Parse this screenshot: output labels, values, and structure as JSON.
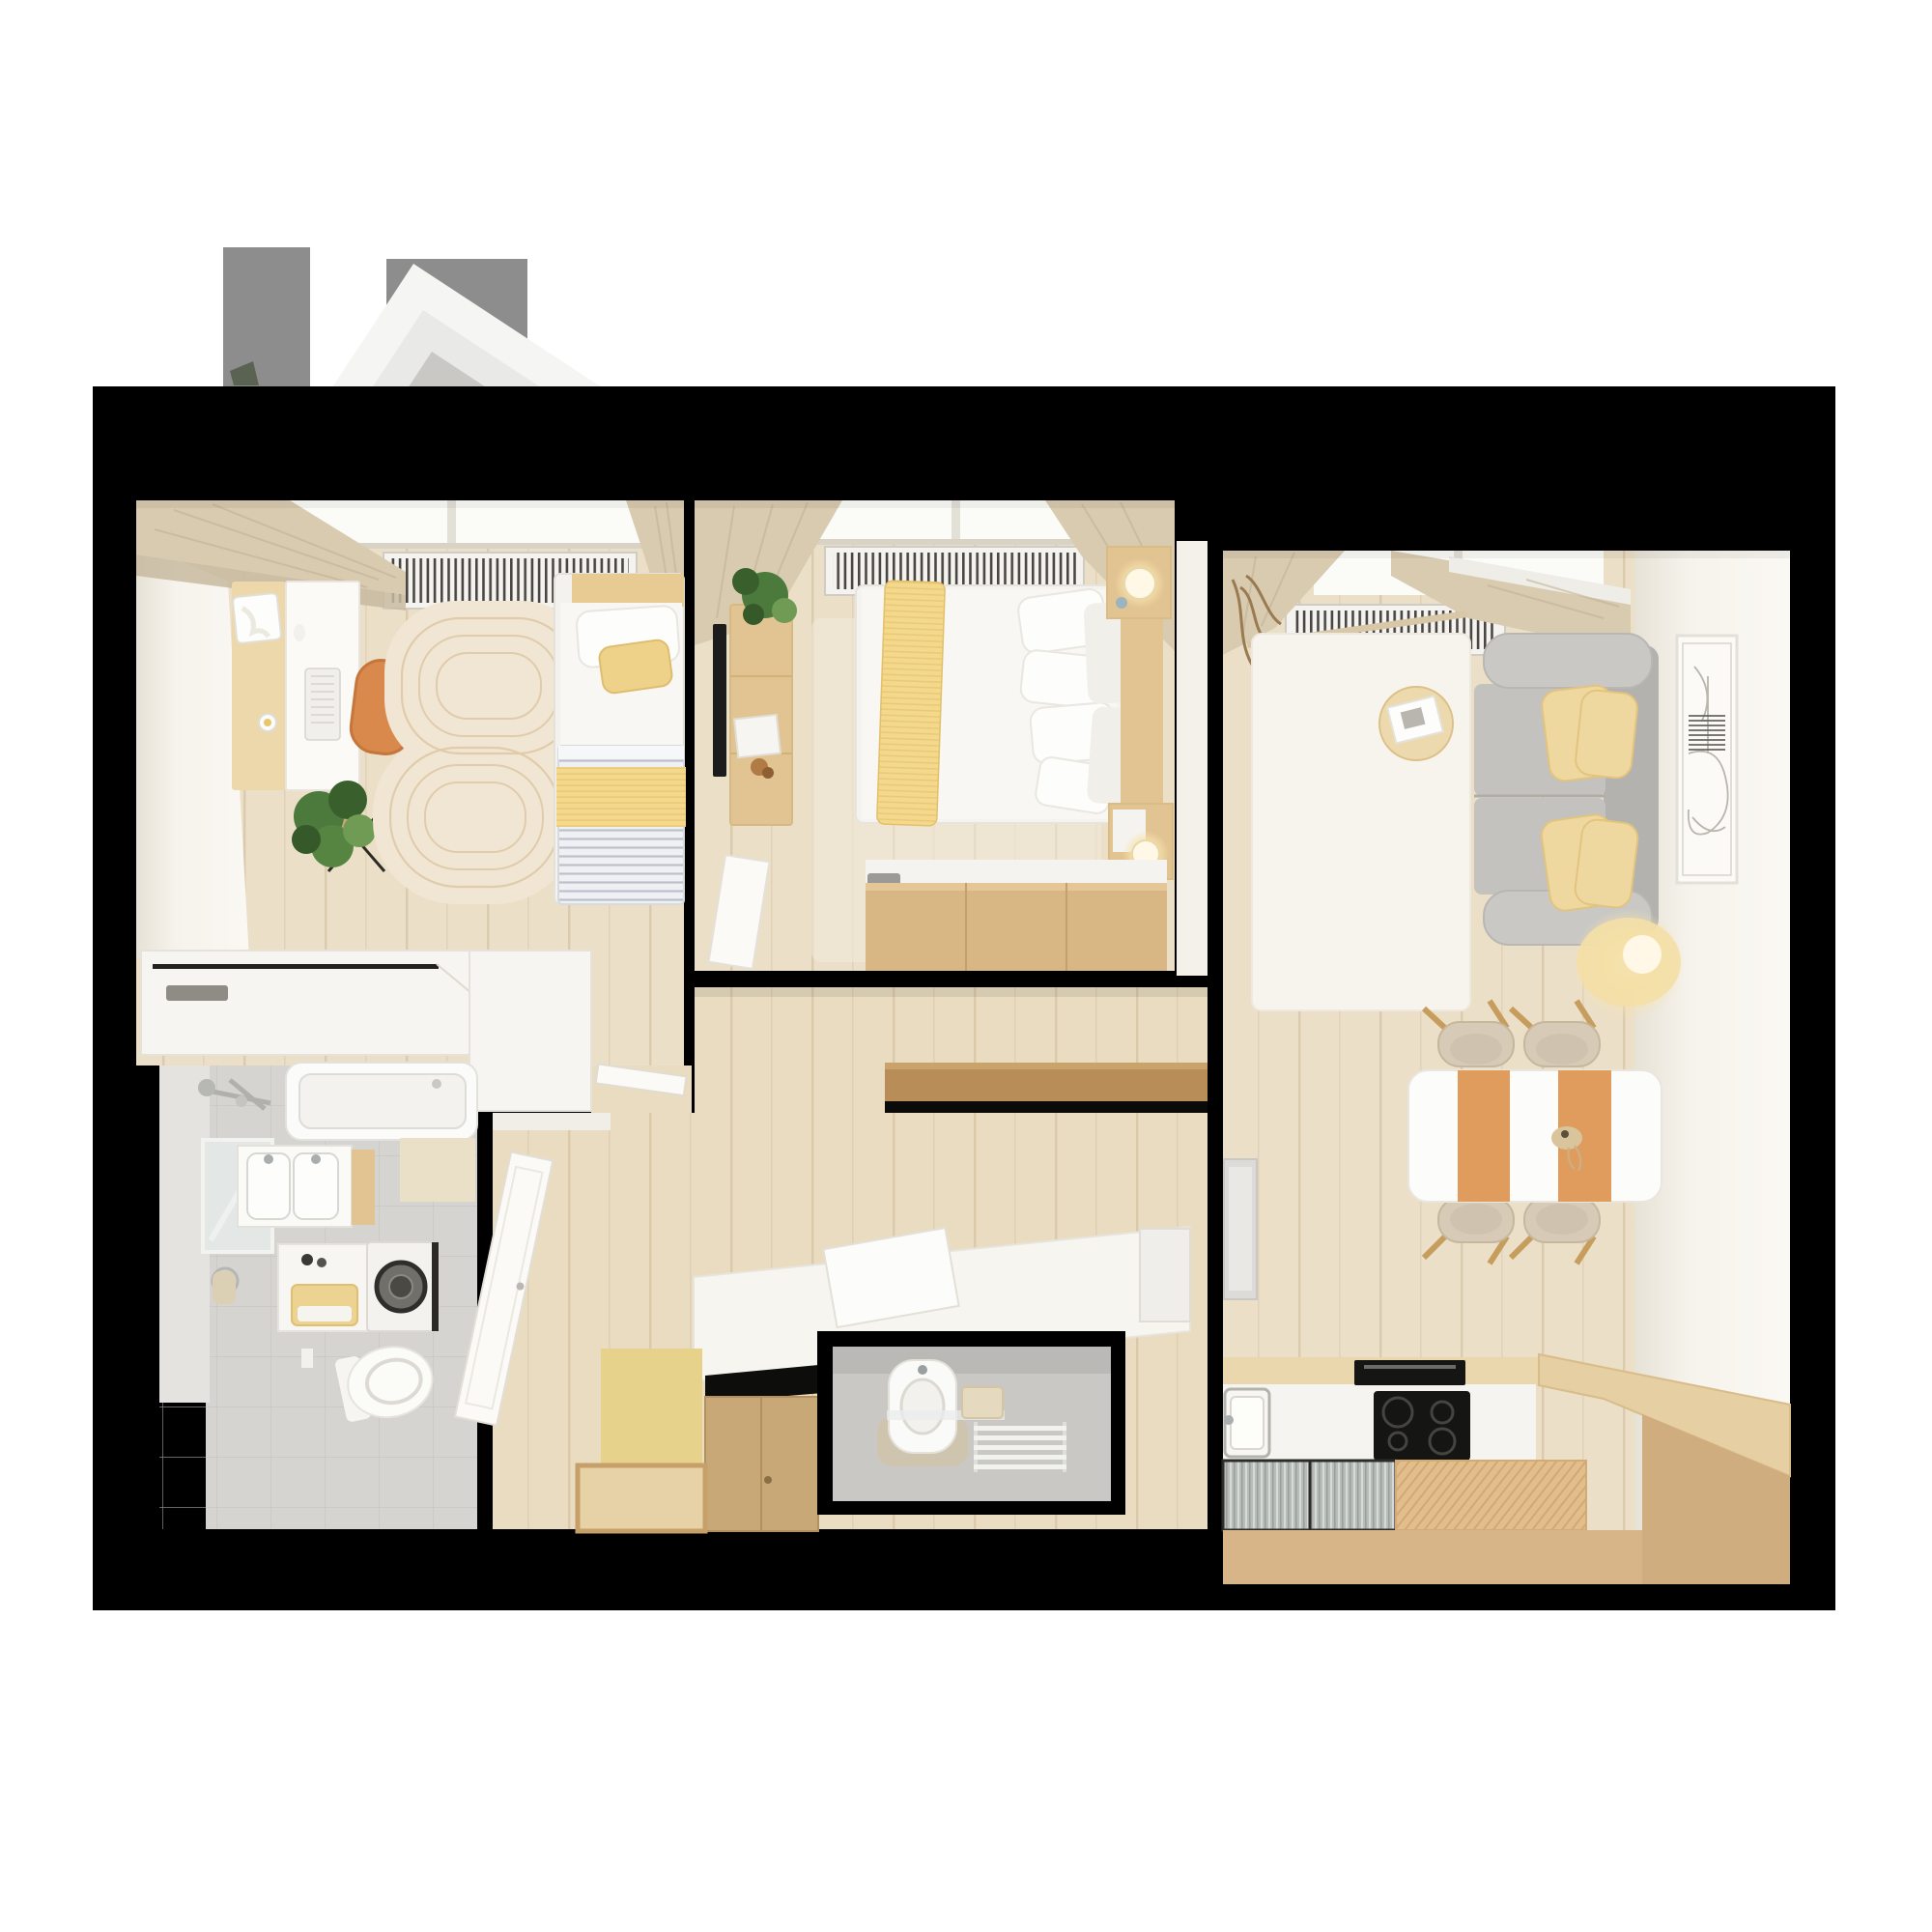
{
  "meta": {
    "title": "apartment-floor-plan-3d-top-view",
    "view": "top-down 3d cutaway render",
    "visible_text": ""
  },
  "colors": {
    "bg": "#ffffff",
    "wall": "#000000",
    "roofGray": "#8d8d8d",
    "roofWhite": "#f5f5f3",
    "roofMid": "#e9e9e7",
    "roofCore": "#c9c8c4",
    "roofGreen": "#5a6351",
    "floor": "#ebdfc8",
    "hallFloor": "#e9dcc1",
    "wallFace": "#f4f1ea",
    "windowGlow": "#fbfbf8",
    "sill": "#d9d3c6",
    "radiator": "#f4f3f0",
    "curtain": "#d8cbb0",
    "curtainDark": "#c8baa0",
    "rug1": "#f0e6d3",
    "rug1Line": "#e0ccab",
    "deskWood": "#ecd8ab",
    "deskWhite": "#fbfaf7",
    "chairOrange": "#d8894b",
    "plantGreen": "#4c7a3c",
    "plantDark": "#39602c",
    "bedWhite": "#f8f7f4",
    "pillowYellow": "#eed28a",
    "headboardTan": "#e7cb92",
    "cabinetWhite": "#f6f5f1",
    "furnWood": "#e2c493",
    "chestWood": "#d8b784",
    "consoleWood": "#b98d58",
    "tvBlack": "#1c1c1c",
    "sofaGray": "#c3c2be",
    "sofaDark": "#b3b2ae",
    "sofaLight": "#c9c8c4",
    "cushionYellow": "#efd8a0",
    "tableWhite": "#fcfcfa",
    "runnerOrange": "#e09c5c",
    "chairBeige": "#d7cab6",
    "chairWood": "#c79d5e",
    "coffeeWood": "#ecd9ae",
    "lampCore": "#fff8e6",
    "artFrame": "#fbfaf7",
    "counterWhite": "#f5f4f0",
    "kcabWood": "#ead7ad",
    "hobBlack": "#151514",
    "cabTan": "#d8b588",
    "benchTop": "#e6cfa2",
    "benchFace": "#cfad7e",
    "tileGray": "#d5d4d0",
    "tileLight": "#e4e3df",
    "tubWhite": "#fbfbf9",
    "towelYellow": "#ecd392",
    "wcFloor": "#c9c8c5",
    "wcWall": "#b7b6b3",
    "doorWhite": "#fbfaf6",
    "yellowWall": "#e6d28b",
    "closetTan": "#c9a878",
    "closetFloor": "#e6d2a6",
    "fridgeGray": "#dcdbd7",
    "rugWhite": "#f7f4ed"
  },
  "rooms": [
    {
      "id": "bedroom-1",
      "label": "bedroom-office",
      "furniture": [
        "desk",
        "office-chair",
        "laptop",
        "keyboard",
        "plant",
        "area-rug",
        "single-bed",
        "radiator",
        "low-cabinet"
      ]
    },
    {
      "id": "bedroom-2",
      "label": "master-bedroom",
      "furniture": [
        "double-bed",
        "yellow-throw",
        "pillows",
        "tv",
        "media-console",
        "plant",
        "nightstand-top",
        "nightstand-bottom",
        "table-lamps",
        "storage-chest",
        "radiator",
        "door"
      ]
    },
    {
      "id": "living-kitchen",
      "label": "living-room-kitchen",
      "furniture": [
        "sofa",
        "yellow-cushions",
        "coffee-table",
        "white-rug",
        "floor-lamp",
        "wall-art",
        "dining-table",
        "orange-runners",
        "dining-chairs",
        "fridge",
        "kitchen-counter",
        "sink",
        "induction-hob",
        "oven",
        "glass-cabinet",
        "slatted-counter",
        "wood-bench",
        "radiator"
      ]
    },
    {
      "id": "bathroom",
      "label": "bathroom",
      "furniture": [
        "bathtub",
        "shower-mixer",
        "mirror",
        "double-vanity",
        "towel-ring",
        "shelf-with-towels",
        "washing-machine",
        "toilet"
      ]
    },
    {
      "id": "hallway",
      "label": "hallway",
      "furniture": [
        "open-door",
        "white-sideboard",
        "open-lid",
        "wood-console",
        "wardrobe-niche",
        "yellow-wall-panel"
      ]
    },
    {
      "id": "wc",
      "label": "guest-wc",
      "furniture": [
        "compact-toilet",
        "glass-shelf",
        "towel-radiator"
      ]
    }
  ],
  "exterior": {
    "roof_skylight": "rotated white skylight with concrete core",
    "roof_shadow_bar": "gray overhang bar top-right"
  }
}
